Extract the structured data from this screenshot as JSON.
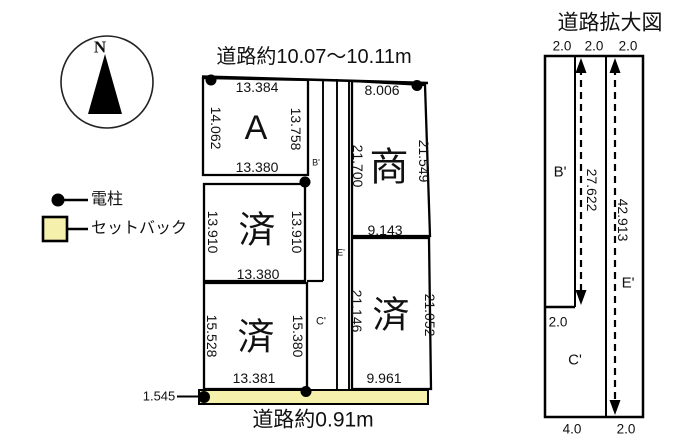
{
  "compass": {
    "north": "N"
  },
  "legend": {
    "pole": "電柱",
    "setback": "セットバック"
  },
  "colors": {
    "setback_fill": "#F5F1AD",
    "line": "#111111"
  },
  "main_plan": {
    "road_top": "道路約10.07〜10.11m",
    "road_bottom": "道路約0.91m",
    "offset_left": "1.545",
    "plot_a": {
      "label": "A",
      "top": "13.384",
      "left": "14.062",
      "right": "13.758",
      "bottom": "13.380"
    },
    "plot_mid_left": {
      "label": "済",
      "left": "13.910",
      "right": "13.910",
      "bottom": "13.380"
    },
    "plot_bottom_left": {
      "label": "済",
      "left": "15.528",
      "right": "15.380",
      "bottom": "13.381"
    },
    "plot_top_right": {
      "label": "商",
      "top": "8.006",
      "left": "21.700",
      "right": "21.549",
      "bottom": "9.143"
    },
    "plot_bottom_right": {
      "label": "済",
      "left": "21.146",
      "right": "21.052",
      "bottom": "9.961"
    },
    "road_b": "B'",
    "road_c": "C'",
    "road_e": "E'"
  },
  "road_detail": {
    "title": "道路拡大図",
    "top_widths": [
      "2.0",
      "2.0",
      "2.0"
    ],
    "b_label": "B'",
    "b_length": "27.622",
    "e_label": "E'",
    "e_length": "42.913",
    "step_width": "2.0",
    "c_label": "C'",
    "bottom_widths": [
      "4.0",
      "2.0"
    ]
  }
}
